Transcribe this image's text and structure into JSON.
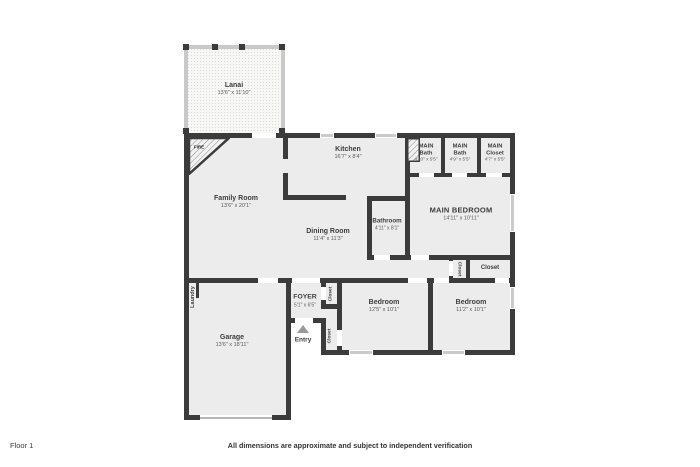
{
  "footer": {
    "floor_label": "Floor 1",
    "disclaimer": "All dimensions are approximate and subject to independent verification"
  },
  "colors": {
    "wall": "#3b3b3b",
    "floor_fill": "#ececec",
    "lanai_fill": "#f7f7f5",
    "lanai_wall": "#c9c9c9",
    "window": "#cbcbcb",
    "text": "#3d3d3d",
    "entry_arrow": "#999999"
  },
  "rooms": {
    "lanai": {
      "name": "Lanai",
      "dims": "13'6\" x 11'10\""
    },
    "fireplace": {
      "label": "FIRE"
    },
    "family_room": {
      "name": "Family Room",
      "dims": "13'6\" x 20'1\""
    },
    "kitchen": {
      "name": "Kitchen",
      "dims": "16'7\" x 8'4\""
    },
    "main_bath_1": {
      "line1": "MAIN",
      "line2": "Bath",
      "dims": "4'10\" x 5'5\""
    },
    "main_bath_2": {
      "line1": "MAIN",
      "line2": "Bath",
      "dims": "4'9\" x 5'5\""
    },
    "main_closet": {
      "line1": "MAIN",
      "line2": "Closet",
      "dims": "4'7\" x 5'5\""
    },
    "main_bedroom": {
      "name": "MAIN BEDROOM",
      "dims": "14'11\" x 10'11\""
    },
    "bathroom": {
      "name": "Bathroom",
      "dims": "4'11\" x 8'1\""
    },
    "dining_room": {
      "name": "Dining Room",
      "dims": "11'4\" x 11'3\""
    },
    "hall_closet": {
      "name": "Closet"
    },
    "main_bedroom_closet": {
      "name": "Closet"
    },
    "laundry": {
      "name": "Laundry"
    },
    "garage": {
      "name": "Garage",
      "dims": "13'6\" x 18'11\""
    },
    "foyer": {
      "name": "FOYER",
      "dims": "5'1\" x 6'5\""
    },
    "foyer_closet": {
      "name": "Closet"
    },
    "bedroom_1_closet": {
      "name": "Closet"
    },
    "entry": {
      "label": "Entry"
    },
    "bedroom_1": {
      "name": "Bedroom",
      "dims": "12'5\" x 10'1\""
    },
    "bedroom_2": {
      "name": "Bedroom",
      "dims": "11'2\" x 10'1\""
    }
  }
}
